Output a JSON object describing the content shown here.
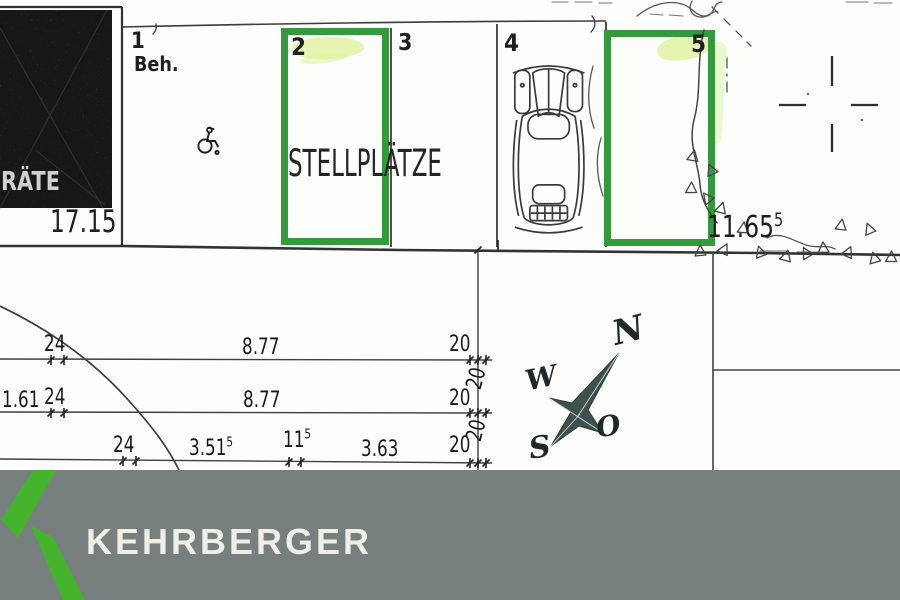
{
  "plan": {
    "storage_block": {
      "label": "RÄTE",
      "width_dim": "17.15"
    },
    "row_label": "STELLPLÄTZE",
    "right_dim": {
      "base": "11.65",
      "sup": "5"
    },
    "spaces": [
      {
        "number": "1",
        "note": "Beh."
      },
      {
        "number": "2",
        "highlighted": true
      },
      {
        "number": "3"
      },
      {
        "number": "4",
        "has_car": true
      },
      {
        "number": "5",
        "highlighted": true
      }
    ],
    "dims": [
      {
        "t": "24"
      },
      {
        "t": "8.77"
      },
      {
        "t": "20"
      },
      {
        "t": "1.61"
      },
      {
        "t": "24"
      },
      {
        "t": "8.77"
      },
      {
        "t": "20"
      },
      {
        "t": "20",
        "rot": true
      },
      {
        "t": "24"
      },
      {
        "t": "3.51",
        "s": "5"
      },
      {
        "t": "11",
        "s": "5"
      },
      {
        "t": "3.63"
      },
      {
        "t": "20"
      },
      {
        "t": "20",
        "rot": true
      }
    ],
    "compass": {
      "n": "N",
      "w": "W",
      "o": "O",
      "s": "S"
    },
    "icons": {
      "wheelchair": "wheelchair-line-symbol",
      "car": "car-top-view-drawing",
      "compass": "compass-rose-star",
      "survey_cross": "survey-cross-mark"
    }
  },
  "footer": {
    "brand": "KEHRBERGER"
  },
  "colors": {
    "box_green": "#339b3e",
    "logo_green": "#45b42c",
    "banner_gray": "#77807e",
    "marker_yellow": "#def29e",
    "line_dark": "#3c3c3c"
  }
}
